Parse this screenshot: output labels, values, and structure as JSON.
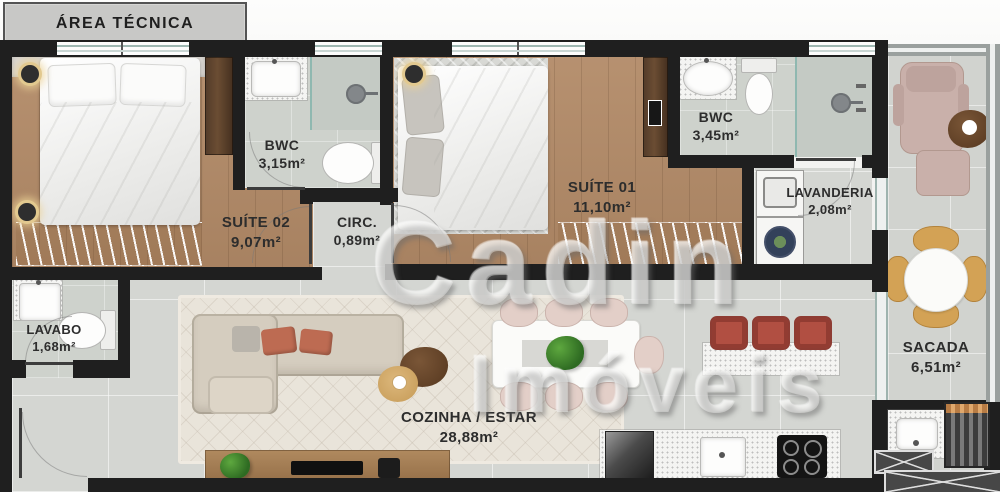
{
  "watermark": {
    "line1": "Cadin",
    "line2": "Imóveis"
  },
  "rooms": {
    "area_tecnica": {
      "name": "ÁREA TÉCNICA"
    },
    "suite02": {
      "name": "SUÍTE 02",
      "area": "9,07m²"
    },
    "bwc_suite02": {
      "name": "BWC",
      "area": "3,15m²"
    },
    "circ": {
      "name": "CIRC.",
      "area": "0,89m²"
    },
    "suite01": {
      "name": "SUÍTE 01",
      "area": "11,10m²"
    },
    "bwc_suite01": {
      "name": "BWC",
      "area": "3,45m²"
    },
    "lavanderia": {
      "name": "LAVANDERIA",
      "area": "2,08m²"
    },
    "lavabo": {
      "name": "LAVABO",
      "area": "1,68m²"
    },
    "cozinha_estar": {
      "name": "COZINHA / ESTAR",
      "area": "28,88m²"
    },
    "sacada": {
      "name": "SACADA",
      "area": "6,51m²"
    }
  },
  "colors": {
    "wall": "#1f1f1f",
    "wood_floor": "#b28a67",
    "tile_floor": "#d4d6d2",
    "bath_floor": "#ced2cc",
    "terracotta_stool": "#b14f42",
    "blush_chair": "#e3cfc8",
    "tan_chair": "#d3a255",
    "lounge_mauve": "#c9b0aa",
    "rug_cream": "#e9e4da"
  }
}
